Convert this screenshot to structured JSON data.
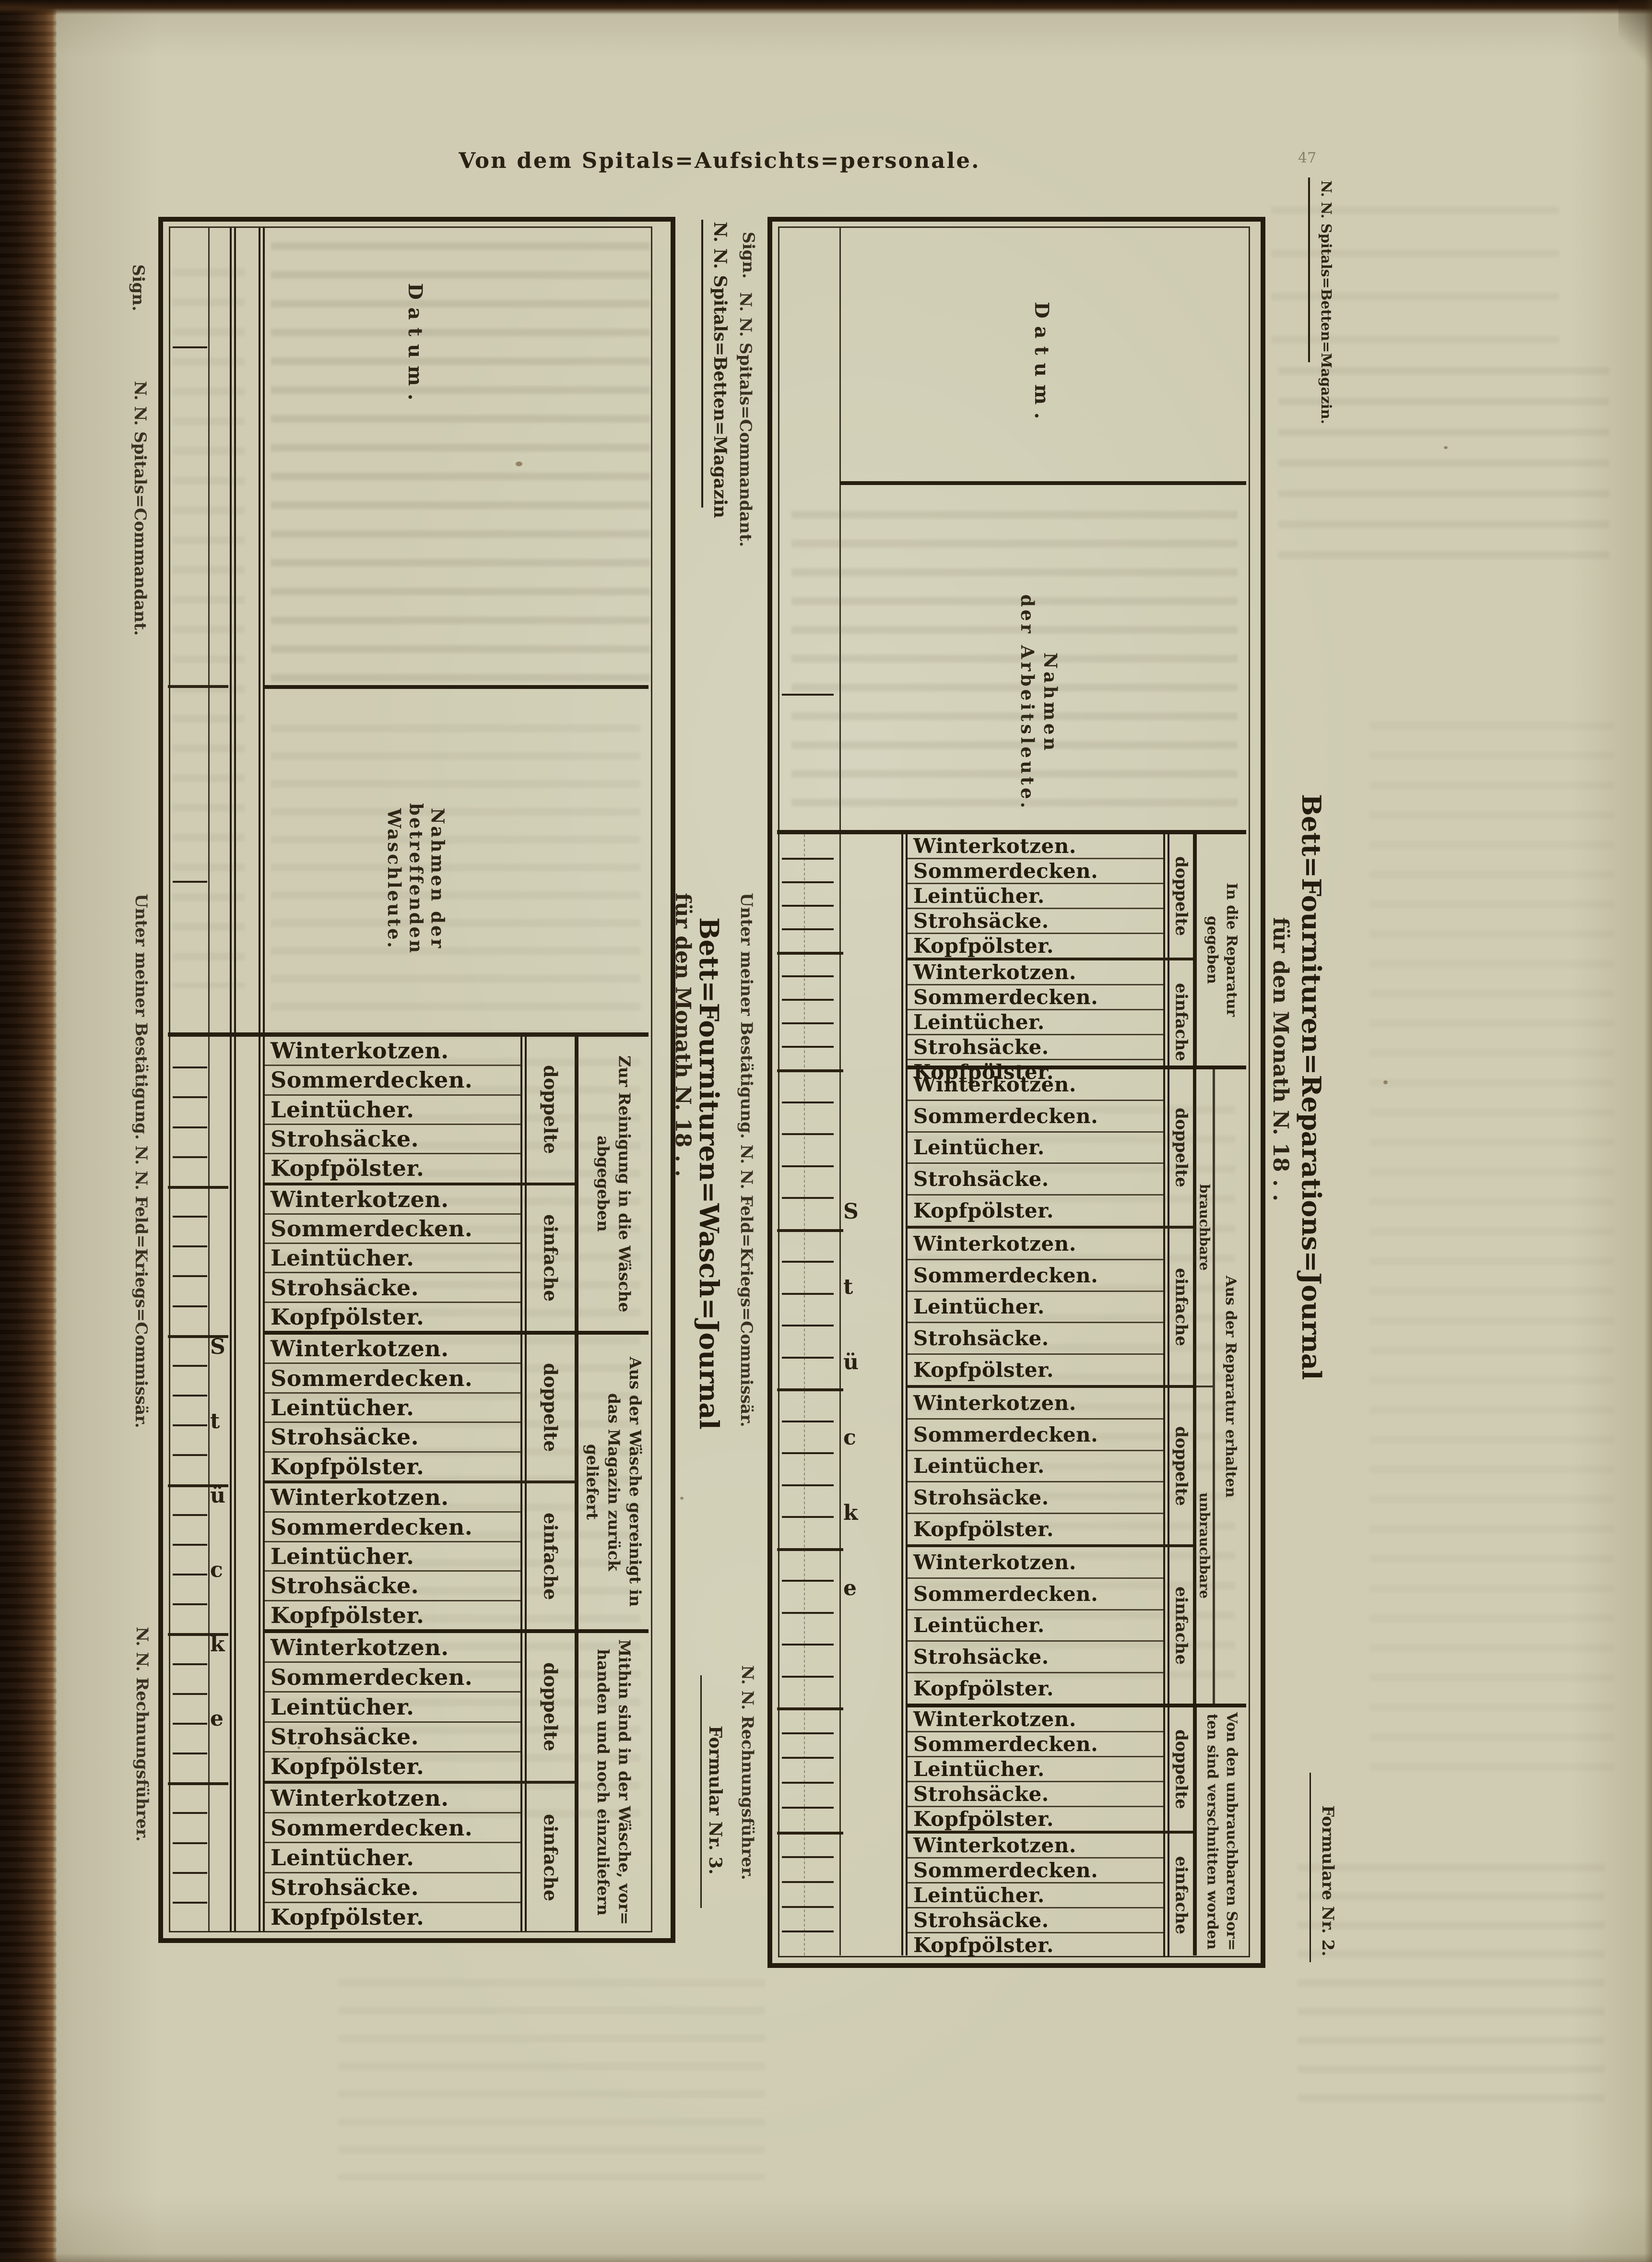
{
  "page": {
    "header": "Von dem Spitals=Aufsichts=personale.",
    "page_number": "47"
  },
  "items": [
    "Winterkotzen.",
    "Sommerdecken.",
    "Leintücher.",
    "Strohsäcke.",
    "Kopfpölster."
  ],
  "stueck_letters": [
    "S",
    "t",
    "ü",
    "c",
    "k",
    "e"
  ],
  "colors": {
    "paper": "#cfccb3",
    "ink": "#241c0e",
    "binding": "#35200f"
  },
  "wash_journal": {
    "form_number": "Formular Nr. 3.",
    "letterhead": "N. N. Spitals=Betten=Magazin",
    "title": "Bett=Fournituren=Wasch=Journal",
    "subtitle": "für den Monath N. 18 . .",
    "datum_label": "Datum.",
    "names_label_lines": [
      "Nahmen der",
      "betreffenden",
      "Waschleute."
    ],
    "signatures": {
      "sign": "Sign.",
      "commandant": "N. N. Spitals=Commandant.",
      "commissar": "Unter meiner Bestätigung.   N. N. Feld=Kriegs=Commissär.",
      "accountant": "N. N. Rechnungsführer."
    },
    "sections": [
      {
        "header_lines": [
          "Zur Reinigung in die Wäsche",
          "abgegeben"
        ],
        "groups": [
          "doppelte",
          "einfache"
        ]
      },
      {
        "header_lines": [
          "Aus der Wäsche gereinigt in",
          "das Magazin zurück",
          "geliefert"
        ],
        "groups": [
          "doppelte",
          "einfache"
        ]
      },
      {
        "header_lines": [
          "Mithin sind in der Wäsche, vor=",
          "handen und noch einzuliefern"
        ],
        "groups": [
          "doppelte",
          "einfache"
        ]
      }
    ]
  },
  "repair_journal": {
    "form_number": "Formulare Nr. 2.",
    "letterhead": "N. N. Spitals=Betten=Magazin.",
    "title": "Bett=Fournituren=Reparations=Journal",
    "subtitle": "für den Monath N. 18 . .",
    "datum_label": "Datum.",
    "names_label_lines": [
      "Nahmen",
      "der Arbeitsleute."
    ],
    "signatures": {
      "sign": "Sign.",
      "commandant": "N. N. Spitals=Commandant.",
      "commissar": "Unter meiner Bestätigung.   N. N. Feld=Kriegs=Commissär.",
      "accountant": "N. N. Rechnungsführer."
    },
    "sections": [
      {
        "header_lines": [
          "In die Reparatur",
          "gegeben"
        ],
        "groups": [
          "doppelte",
          "einfache"
        ]
      },
      {
        "header_lines": [
          "Aus der Reparatur erhalten"
        ],
        "sub_headers": [
          "brauchbare",
          "unbrauchbare"
        ],
        "groups": [
          "doppelte",
          "einfache",
          "doppelte",
          "einfache"
        ]
      },
      {
        "header_lines": [
          "Von den unbrauchbaren Sor=",
          "ten sind verschnitten worden"
        ],
        "groups": [
          "doppelte",
          "einfache"
        ]
      }
    ]
  }
}
